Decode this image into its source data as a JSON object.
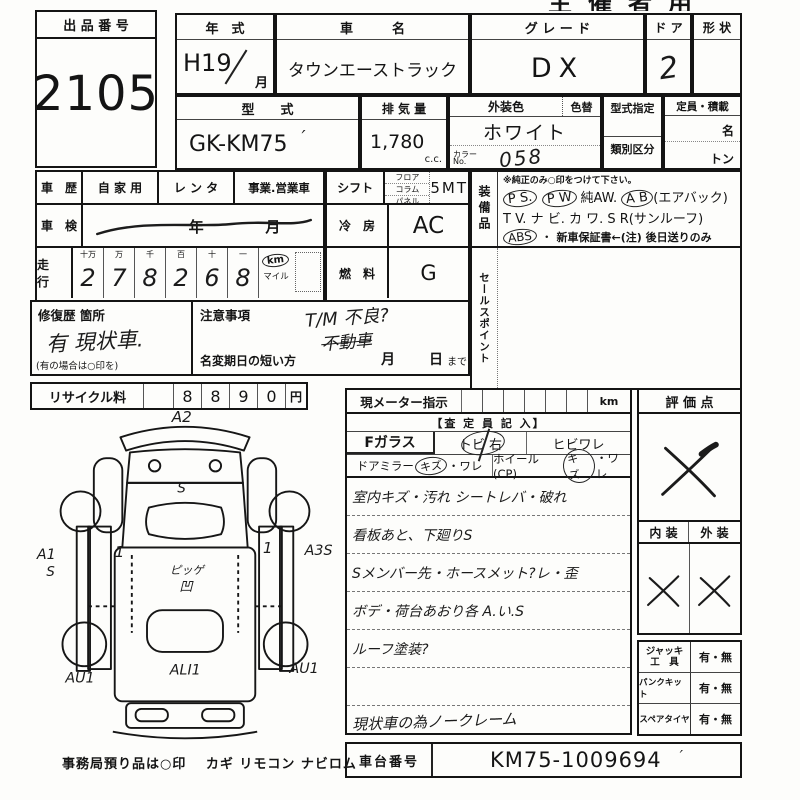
{
  "top_cut_text": "主催者用",
  "auction_no": {
    "label": "出 品 番 号",
    "value": "2105"
  },
  "row1": {
    "year_label": "年　式",
    "year_value": "H19",
    "month": "月",
    "name_label": "車　　　名",
    "name_value": "タウンエーストラック",
    "grade_label": "グ レ ー ド",
    "grade_value": "DX",
    "door_label": "ド ア",
    "door_value": "2",
    "shape_label": "形 状"
  },
  "row2": {
    "model_label": "型　　式",
    "model_value": "GK-KM75",
    "model_tick": "′",
    "disp_label": "排 気 量",
    "disp_value": "1,780",
    "disp_unit": "c.c.",
    "color_label": "外装色",
    "color_change": "色替",
    "color_value": "ホワイト",
    "color_no_label1": "カラー",
    "color_no_label2": "No.",
    "color_no": "058",
    "type_desig": "型式指定",
    "class_div": "類別区分",
    "capacity_label": "定員・積載",
    "persons": "名",
    "tons": "トン"
  },
  "history": {
    "label": "車　歴",
    "opt1": "自 家 用",
    "opt2": "レ ン タ",
    "opt3": "事業.営業車"
  },
  "shaken": {
    "label": "車　検",
    "year": "年",
    "month": "月"
  },
  "mileage": {
    "label": "走　行",
    "h1": "十万",
    "h2": "万",
    "h3": "千",
    "h4": "百",
    "h5": "十",
    "h6": "一",
    "d1": "2",
    "d2": "7",
    "d3": "8",
    "d4": "2",
    "d5": "6",
    "d6": "8",
    "km": "km",
    "mile": "マイル"
  },
  "shift": {
    "label": "シフト",
    "floor": "フロア",
    "column": "コラム",
    "panel": "パネル",
    "value": "5MT"
  },
  "cooling": {
    "label": "冷　房",
    "value": "AC"
  },
  "fuel": {
    "label": "燃　料",
    "value": "G"
  },
  "equipment": {
    "label": "装備品",
    "note": "※純正のみ○印をつけて下さい。",
    "ps": "P S.",
    "pw": "P W",
    "aw": "純AW.",
    "ab": "A B",
    "ab_paren": "(エアバック)",
    "tv": "T V.",
    "navi": "ナ ビ.",
    "kawa": "カ ワ.",
    "sr": "S R(サンルーフ)",
    "abs": "ABS",
    "dot": "・",
    "warranty": "新車保証書←(注) 後日送りのみ"
  },
  "sales_point": {
    "label": "セールスポイント"
  },
  "repair": {
    "label": "修復歴 箇所",
    "value": "有  現状車.",
    "note": "(有の場合は○印を)"
  },
  "caution": {
    "label": "注意事項",
    "hw1": "T/M 不良?",
    "hw2": "不動車",
    "rename": "名変期日の短い方",
    "month": "月",
    "day": "日",
    "made": "まで"
  },
  "recycle": {
    "label": "リサイクル料",
    "d1": "8",
    "d2": "8",
    "d3": "9",
    "d4": "0",
    "yen": "円"
  },
  "meter": {
    "label": "現メーター指示",
    "unit": "km"
  },
  "assessor": {
    "header": "【査 定 員 記 入】",
    "f_glass": "Fガラス",
    "tobi": "トビ 右",
    "hibi": "ヒビワレ",
    "mirror": "ドアミラー",
    "mirror_kizu": "キズ",
    "mirror_ware": "・ワレ",
    "wheel": "ホイール(CP)",
    "wheel_kizu": "キズ",
    "wheel_ware": "・ワレ",
    "note1": "室内キズ・汚れ シートレバ・破れ",
    "note2": "看板あと、下廻りS",
    "note3": "Sメンバー先・ホースメット?レ・歪",
    "note4": "ボデ・荷台あおり各 A.い.S",
    "note5": "ルーフ塗装?",
    "bottom": "現状車の為ノークレーム"
  },
  "evaluation": {
    "label": "評 価 点",
    "interior": "内 装",
    "exterior": "外 装"
  },
  "tools": {
    "jack1": "ジャッキ",
    "jack2": "工　具",
    "jack_v": "有・無",
    "pank": "パンクキット",
    "pank_v": "有・無",
    "spare": "スペアタイヤ",
    "spare_v": "有・無"
  },
  "chassis": {
    "label": "車台番号",
    "value": "KM75-1009694",
    "tick": "′"
  },
  "office_note": "事務局預り品は○印　 カギ  リモコン  ナビロム",
  "diagram": {
    "a2": "A2",
    "hood_s": "S",
    "door_l": "1",
    "door_r": "1",
    "a1": "A1",
    "a1s": "S",
    "a3s": "A3S",
    "bed1": "ピッゲ",
    "bed2": "凹",
    "rear_l": "AU1",
    "rear_c": "ALI1",
    "rear_r": "AU1"
  }
}
